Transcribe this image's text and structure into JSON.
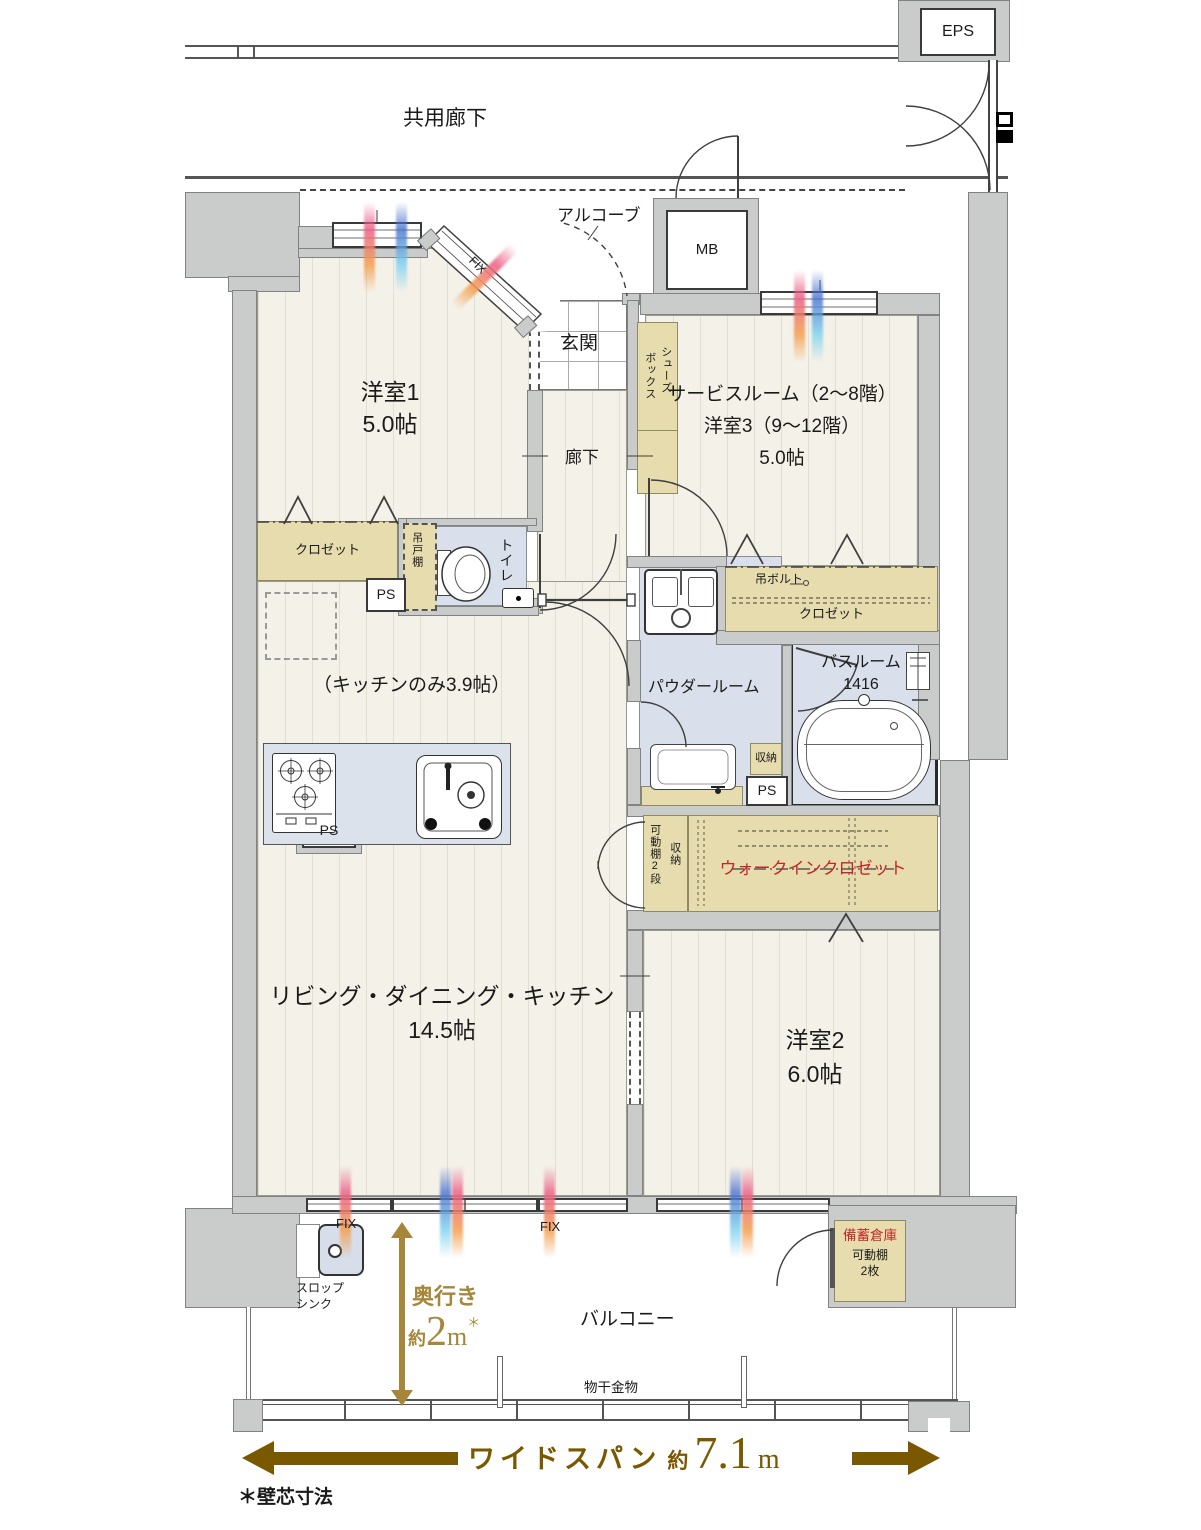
{
  "colors": {
    "wall": "#C9CCCA",
    "storage_beige": "#E6DCAE",
    "wet_blue": "#DAE0EB",
    "floor": "#F4F1E8",
    "accent_red": "#C3272B",
    "gold": "#A5863B",
    "brown": "#7A5800"
  },
  "corridor": {
    "label": "共用廊下"
  },
  "eps": {
    "label": "EPS"
  },
  "alcove": {
    "label": "アルコーブ"
  },
  "mb": {
    "label": "MB"
  },
  "entrance": {
    "label": "玄関"
  },
  "shoes_box": {
    "line1": "シューズ",
    "line2": "ボックス"
  },
  "room1": {
    "name": "洋室1",
    "size": "5.0帖",
    "closet": "クロゼット",
    "fix": "FIX"
  },
  "hallway": {
    "label": "廊下"
  },
  "toilet": {
    "label": "トイレ",
    "cupboard": "吊戸棚",
    "ps": "PS"
  },
  "service_room": {
    "line1": "サービスルーム（2～8階）",
    "line2": "洋室3（9～12階）",
    "line3": "5.0帖",
    "bolt": "吊ボルト",
    "closet": "クロゼット"
  },
  "kitchen": {
    "note": "（キッチンのみ3.9帖）",
    "ps": "PS"
  },
  "powder": {
    "label": "パウダールーム",
    "storage": "収納",
    "ps": "PS"
  },
  "bath": {
    "name": "バスルーム",
    "size": "1416"
  },
  "wic": {
    "label": "ウォークインクロゼット",
    "shelf": "可動棚2段",
    "storage": "収納"
  },
  "ldk": {
    "name": "リビング・ダイニング・キッチン",
    "size": "14.5帖"
  },
  "room2": {
    "name": "洋室2",
    "size": "6.0帖"
  },
  "stock": {
    "name": "備蓄倉庫",
    "shelf": "可動棚",
    "count": "2枚"
  },
  "balcony": {
    "label": "バルコニー",
    "laundry": "物干金物",
    "slop_line1": "スロップ",
    "slop_line2": "シンク",
    "fix_left": "FIX",
    "fix_mid": "FIX",
    "depth": {
      "label": "奥行き",
      "approx": "約",
      "value": "2",
      "unit": "m",
      "note": "＊"
    },
    "span": {
      "label": "ワイドスパン",
      "approx": "約",
      "value": "7.1",
      "unit": "m"
    }
  },
  "footnote": "＊壁芯寸法"
}
